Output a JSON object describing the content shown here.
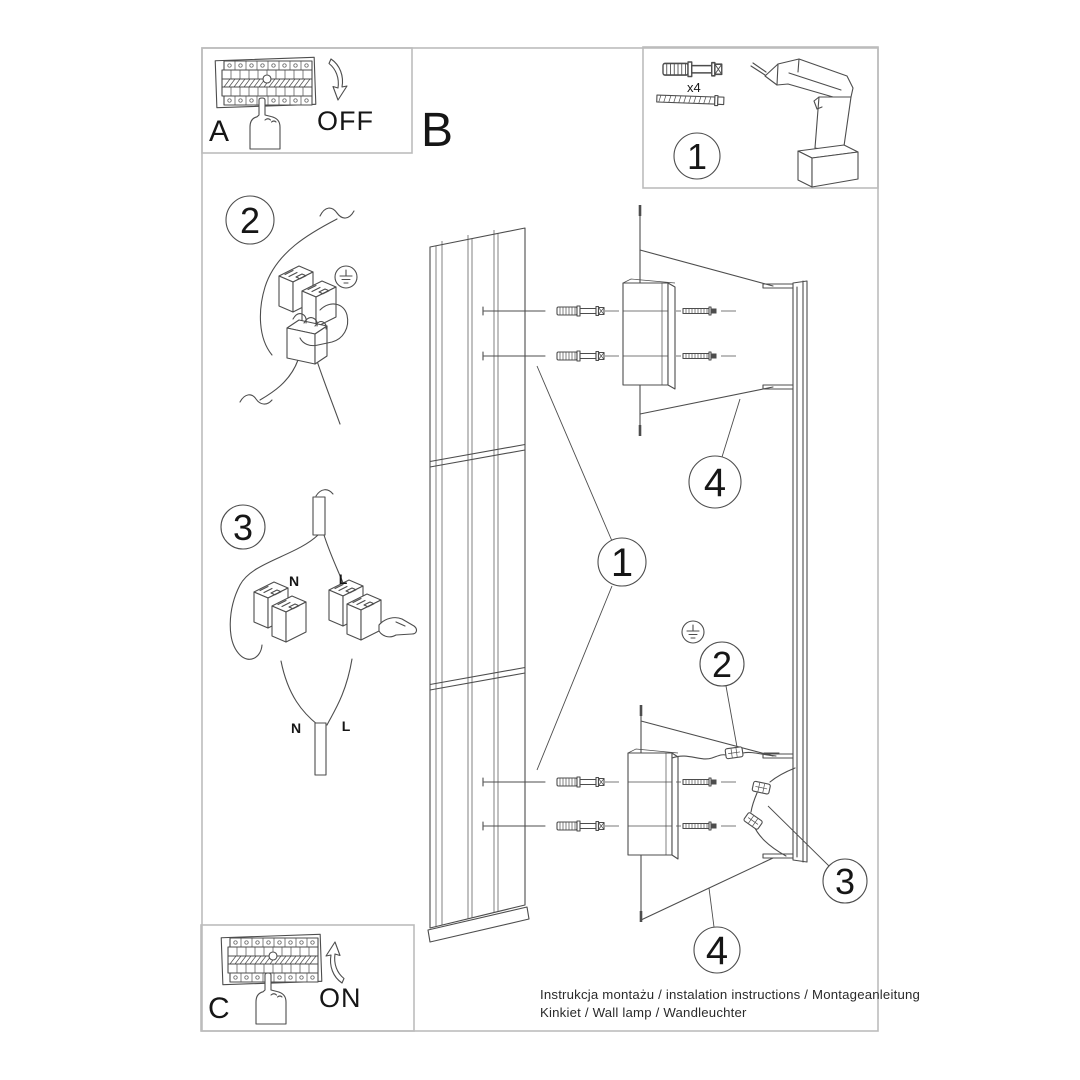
{
  "sections": {
    "a_label": "A",
    "b_label": "B",
    "c_label": "C",
    "off_label": "OFF",
    "on_label": "ON"
  },
  "tools_box": {
    "step_number": "1",
    "anchor_quantity": "x4"
  },
  "callouts": {
    "step2_left": "2",
    "step3_left": "3",
    "lamp_body": "1",
    "bracket_top": "4",
    "ground_wire": "2",
    "connectors": "3",
    "bracket_bottom": "4"
  },
  "wiring_labels": {
    "n_top": "N",
    "l_top": "L",
    "n_bottom": "N",
    "l_bottom": "L"
  },
  "footer": {
    "line1": "Instrukcja montażu / instalation instructions / Montageanleitung",
    "line2": "Kinkiet / Wall lamp / Wandleuchter"
  },
  "colors": {
    "line": "#4d4d4d",
    "frame": "#bcbcbc",
    "text": "#161616"
  }
}
